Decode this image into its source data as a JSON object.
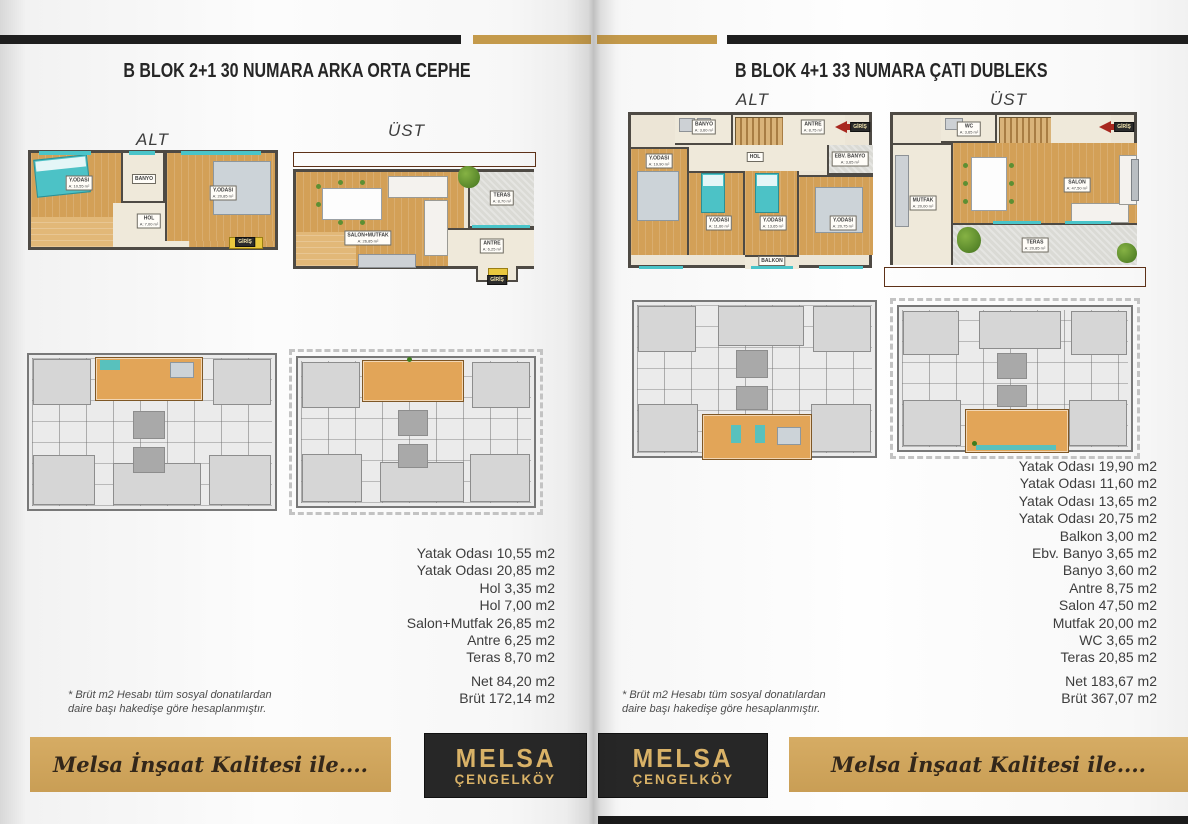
{
  "spread": {
    "left_page": {
      "title": "B BLOK 2+1 30 NUMARA ARKA ORTA CEPHE",
      "lower_label": "ALT",
      "upper_label": "ÜST",
      "measurements": [
        "Yatak Odası 10,55 m2",
        "Yatak Odası 20,85 m2",
        "Hol 3,35 m2",
        "Hol 7,00 m2",
        "Salon+Mutfak 26,85 m2",
        "Antre 6,25 m2",
        "Teras 8,70 m2"
      ],
      "net": "Net 84,20 m2",
      "brut": "Brüt 172,14 m2",
      "footnote1": "* Brüt m2 Hesabı tüm sosyal donatılardan",
      "footnote2": "daire başı hakedişe göre hesaplanmıştır.",
      "banner_text": "Melsa İnşaat Kalitesi ile....",
      "logo1": "MELSA",
      "logo2": "ÇENGELKÖY"
    },
    "right_page": {
      "title": "B BLOK 4+1 33 NUMARA ÇATI DUBLEKS",
      "lower_label": "ALT",
      "upper_label": "ÜST",
      "measurements": [
        "Yatak Odası 19,90 m2",
        "Yatak Odası 11,60 m2",
        "Yatak Odası 13,65 m2",
        "Yatak Odası 20,75 m2",
        "Balkon 3,00 m2",
        "Ebv. Banyo 3,65 m2",
        "Banyo 3,60 m2",
        "Antre 8,75 m2",
        "Salon 47,50 m2",
        "Mutfak 20,00 m2",
        "WC 3,65 m2",
        "Teras 20,85 m2"
      ],
      "net": "Net 183,67 m2",
      "brut": "Brüt 367,07 m2",
      "footnote1": "* Brüt m2 Hesabı tüm sosyal donatılardan",
      "footnote2": "daire başı hakedişe göre hesaplanmıştır.",
      "banner_text": "Melsa İnşaat Kalitesi ile....",
      "logo1": "MELSA",
      "logo2": "ÇENGELKÖY"
    }
  },
  "plans": {
    "left_alt": {
      "rooms": [
        {
          "n": "Y.ODASI",
          "a": "A: 10,55 m²"
        },
        {
          "n": "BANYO"
        },
        {
          "n": "Y.ODASI",
          "a": "A: 20,85 m²"
        },
        {
          "n": "HOL",
          "a": "A: 7,00 m²"
        },
        {
          "n": "GİRİŞ"
        }
      ]
    },
    "left_ust": {
      "rooms": [
        {
          "n": "SALON+MUTFAK",
          "a": "A: 26,85 m²"
        },
        {
          "n": "TERAS",
          "a": "A: 8,70 m²"
        },
        {
          "n": "ANTRE",
          "a": "A: 6,25 m²"
        },
        {
          "n": "GİRİŞ"
        }
      ]
    },
    "right_alt": {
      "rooms": [
        {
          "n": "BANYO",
          "a": "A: 3,60 m²"
        },
        {
          "n": "ANTRE",
          "a": "A: 8,75 m²"
        },
        {
          "n": "GİRİŞ"
        },
        {
          "n": "EBV. BANYO",
          "a": "A: 3,65 m²"
        },
        {
          "n": "HOL"
        },
        {
          "n": "Y.ODASI",
          "a": "A: 19,90 m²"
        },
        {
          "n": "Y.ODASI",
          "a": "A: 11,60 m²"
        },
        {
          "n": "Y.ODASI",
          "a": "A: 13,65 m²"
        },
        {
          "n": "Y.ODASI",
          "a": "A: 20,75 m²"
        },
        {
          "n": "BALKON",
          "a": "A: 3,00 m²"
        }
      ]
    },
    "right_ust": {
      "rooms": [
        {
          "n": "WC",
          "a": "A: 3,65 m²"
        },
        {
          "n": "GİRİŞ"
        },
        {
          "n": "MUTFAK",
          "a": "A: 20,00 m²"
        },
        {
          "n": "SALON",
          "a": "A: 47,50 m²"
        },
        {
          "n": "TERAS",
          "a": "A: 20,85 m²"
        }
      ]
    }
  },
  "colors": {
    "gold": "#c49a4b",
    "banner_gold": "#d0a55c",
    "bar_black": "#1e1e1e",
    "wood": "#d3a057",
    "teal": "#49c4c9",
    "unit_highlight": "#e2a558"
  }
}
